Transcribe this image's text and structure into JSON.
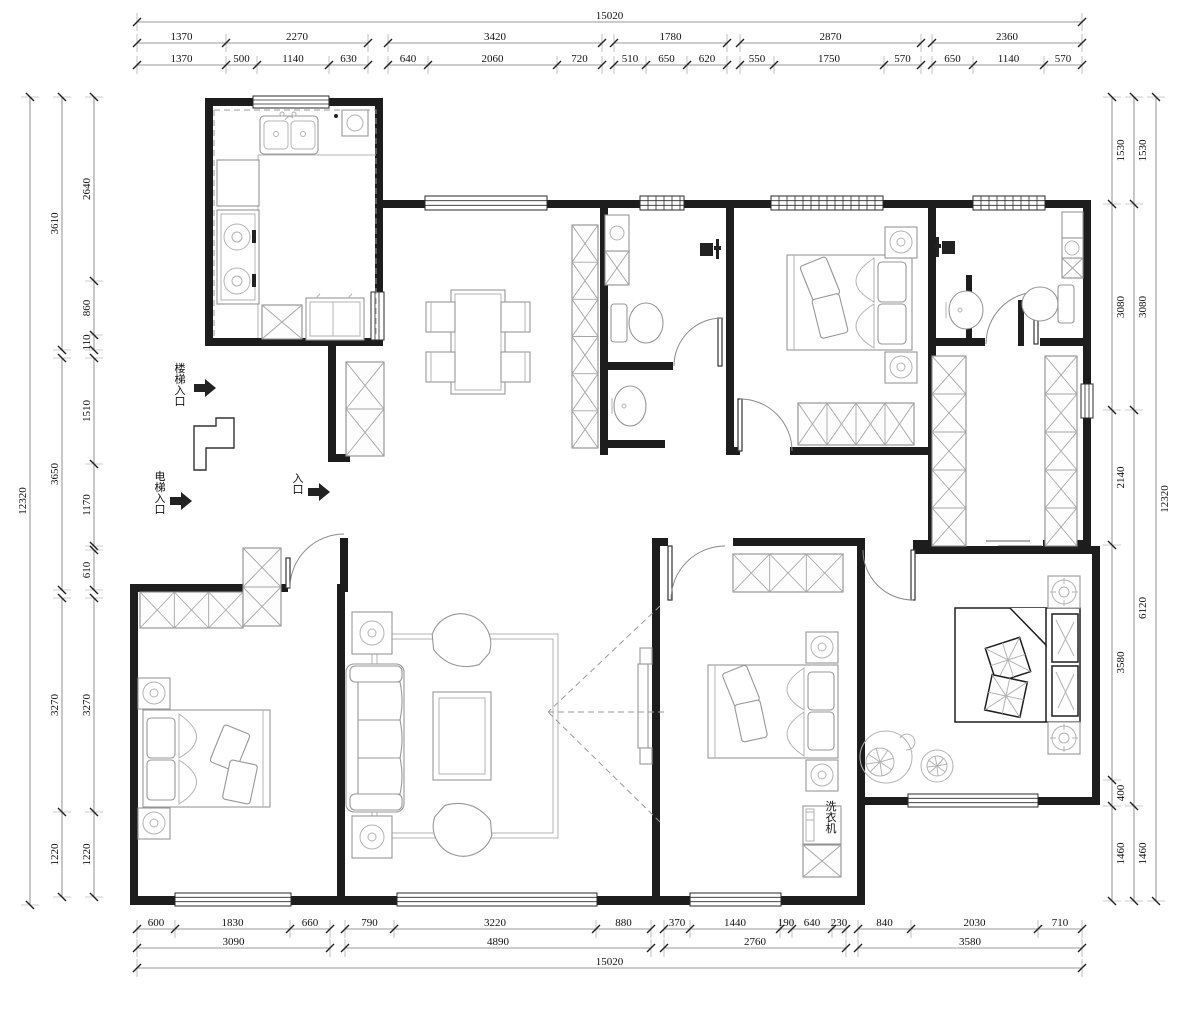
{
  "drawing_title": "apartment-floor-plan",
  "plan_labels": [
    {
      "id": "stairs-entrance",
      "t": "楼梯入口",
      "x": 180,
      "y": 372,
      "vertical": true
    },
    {
      "id": "elevator-entrance",
      "t": "电梯入口",
      "x": 160,
      "y": 480,
      "vertical": true
    },
    {
      "id": "entrance",
      "t": "入口",
      "x": 298,
      "y": 482,
      "vertical": true
    },
    {
      "id": "washing-machine",
      "t": "洗衣机",
      "x": 831,
      "y": 810,
      "vertical": true
    }
  ],
  "dimensions": {
    "top": [
      {
        "o": "h",
        "c": 22,
        "segs": [
          {
            "t": "15020",
            "a": 137,
            "b": 1082
          }
        ]
      },
      {
        "o": "h",
        "c": 43,
        "segs": [
          {
            "t": "1370",
            "a": 137,
            "b": 226
          },
          {
            "t": "2270",
            "a": 226,
            "b": 368
          }
        ]
      },
      {
        "o": "h",
        "c": 43,
        "segs": [
          {
            "t": "3420",
            "a": 388,
            "b": 602
          }
        ]
      },
      {
        "o": "h",
        "c": 43,
        "segs": [
          {
            "t": "1780",
            "a": 614,
            "b": 727
          }
        ]
      },
      {
        "o": "h",
        "c": 43,
        "segs": [
          {
            "t": "2870",
            "a": 740,
            "b": 921
          }
        ]
      },
      {
        "o": "h",
        "c": 43,
        "segs": [
          {
            "t": "2360",
            "a": 932,
            "b": 1082
          }
        ]
      },
      {
        "o": "h",
        "c": 65,
        "segs": [
          {
            "t": "1370",
            "a": 137,
            "b": 226
          },
          {
            "t": "500",
            "a": 226,
            "b": 257
          },
          {
            "t": "1140",
            "a": 257,
            "b": 329
          },
          {
            "t": "630",
            "a": 329,
            "b": 368
          }
        ]
      },
      {
        "o": "h",
        "c": 65,
        "segs": [
          {
            "t": "640",
            "a": 388,
            "b": 428
          },
          {
            "t": "2060",
            "a": 428,
            "b": 557
          },
          {
            "t": "720",
            "a": 557,
            "b": 602
          }
        ]
      },
      {
        "o": "h",
        "c": 65,
        "segs": [
          {
            "t": "510",
            "a": 614,
            "b": 646
          },
          {
            "t": "650",
            "a": 646,
            "b": 687
          },
          {
            "t": "620",
            "a": 687,
            "b": 727
          }
        ]
      },
      {
        "o": "h",
        "c": 65,
        "segs": [
          {
            "t": "550",
            "a": 740,
            "b": 774
          },
          {
            "t": "1750",
            "a": 774,
            "b": 884
          },
          {
            "t": "570",
            "a": 884,
            "b": 921
          }
        ]
      },
      {
        "o": "h",
        "c": 65,
        "segs": [
          {
            "t": "650",
            "a": 932,
            "b": 973
          },
          {
            "t": "1140",
            "a": 973,
            "b": 1044
          },
          {
            "t": "570",
            "a": 1044,
            "b": 1082
          }
        ]
      }
    ],
    "bottom": [
      {
        "o": "h",
        "c": 929,
        "segs": [
          {
            "t": "600",
            "a": 137,
            "b": 175
          },
          {
            "t": "1830",
            "a": 175,
            "b": 290
          },
          {
            "t": "660",
            "a": 290,
            "b": 330
          }
        ]
      },
      {
        "o": "h",
        "c": 929,
        "segs": [
          {
            "t": "790",
            "a": 345,
            "b": 394
          },
          {
            "t": "3220",
            "a": 394,
            "b": 596
          },
          {
            "t": "880",
            "a": 596,
            "b": 651
          }
        ]
      },
      {
        "o": "h",
        "c": 929,
        "segs": [
          {
            "t": "370",
            "a": 664,
            "b": 690
          },
          {
            "t": "1440",
            "a": 690,
            "b": 780
          },
          {
            "t": "190",
            "a": 780,
            "b": 792
          },
          {
            "t": "640",
            "a": 792,
            "b": 832
          },
          {
            "t": "230",
            "a": 832,
            "b": 846
          }
        ]
      },
      {
        "o": "h",
        "c": 929,
        "segs": [
          {
            "t": "840",
            "a": 858,
            "b": 911
          },
          {
            "t": "2030",
            "a": 911,
            "b": 1038
          },
          {
            "t": "710",
            "a": 1038,
            "b": 1082
          }
        ]
      },
      {
        "o": "h",
        "c": 948,
        "segs": [
          {
            "t": "3090",
            "a": 137,
            "b": 330
          }
        ]
      },
      {
        "o": "h",
        "c": 948,
        "segs": [
          {
            "t": "4890",
            "a": 345,
            "b": 651
          }
        ]
      },
      {
        "o": "h",
        "c": 948,
        "segs": [
          {
            "t": "2760",
            "a": 664,
            "b": 846
          }
        ]
      },
      {
        "o": "h",
        "c": 948,
        "segs": [
          {
            "t": "3580",
            "a": 858,
            "b": 1082
          }
        ]
      },
      {
        "o": "h",
        "c": 968,
        "segs": [
          {
            "t": "15020",
            "a": 137,
            "b": 1082
          }
        ]
      }
    ],
    "left": [
      {
        "o": "v",
        "c": 30,
        "side": "l",
        "segs": [
          {
            "t": "12320",
            "a": 97,
            "b": 905
          }
        ]
      },
      {
        "o": "v",
        "c": 62,
        "side": "l",
        "segs": [
          {
            "t": "3610",
            "a": 97,
            "b": 350
          }
        ]
      },
      {
        "o": "v",
        "c": 62,
        "side": "l",
        "segs": [
          {
            "t": "3650",
            "a": 358,
            "b": 590
          }
        ]
      },
      {
        "o": "v",
        "c": 62,
        "side": "l",
        "segs": [
          {
            "t": "3270",
            "a": 598,
            "b": 812
          },
          {
            "t": "1220",
            "a": 812,
            "b": 897
          }
        ]
      },
      {
        "o": "v",
        "c": 94,
        "side": "l",
        "segs": [
          {
            "t": "2640",
            "a": 97,
            "b": 281
          },
          {
            "t": "860",
            "a": 281,
            "b": 335
          },
          {
            "t": "110",
            "a": 335,
            "b": 350
          }
        ]
      },
      {
        "o": "v",
        "c": 94,
        "side": "l",
        "segs": [
          {
            "t": "1510",
            "a": 358,
            "b": 464
          },
          {
            "t": "1170",
            "a": 464,
            "b": 546
          }
        ]
      },
      {
        "o": "v",
        "c": 94,
        "side": "l",
        "segs": [
          {
            "t": "610",
            "a": 550,
            "b": 590
          }
        ]
      },
      {
        "o": "v",
        "c": 94,
        "side": "l",
        "segs": [
          {
            "t": "3270",
            "a": 598,
            "b": 812
          },
          {
            "t": "1220",
            "a": 812,
            "b": 897
          }
        ]
      }
    ],
    "right": [
      {
        "o": "v",
        "c": 1112,
        "side": "r",
        "segs": [
          {
            "t": "1530",
            "a": 97,
            "b": 204
          },
          {
            "t": "3080",
            "a": 204,
            "b": 410
          },
          {
            "t": "2140",
            "a": 410,
            "b": 545
          },
          {
            "t": "3580",
            "a": 545,
            "b": 780
          },
          {
            "t": "400",
            "a": 780,
            "b": 806
          },
          {
            "t": "1460",
            "a": 806,
            "b": 901
          }
        ]
      },
      {
        "o": "v",
        "c": 1134,
        "side": "r",
        "segs": [
          {
            "t": "1530",
            "a": 97,
            "b": 204
          },
          {
            "t": "3080",
            "a": 204,
            "b": 410
          },
          {
            "t": "6120",
            "a": 410,
            "b": 806
          },
          {
            "t": "1460",
            "a": 806,
            "b": 901
          }
        ]
      },
      {
        "o": "v",
        "c": 1156,
        "side": "r",
        "segs": [
          {
            "t": "12320",
            "a": 97,
            "b": 901
          }
        ]
      }
    ]
  }
}
